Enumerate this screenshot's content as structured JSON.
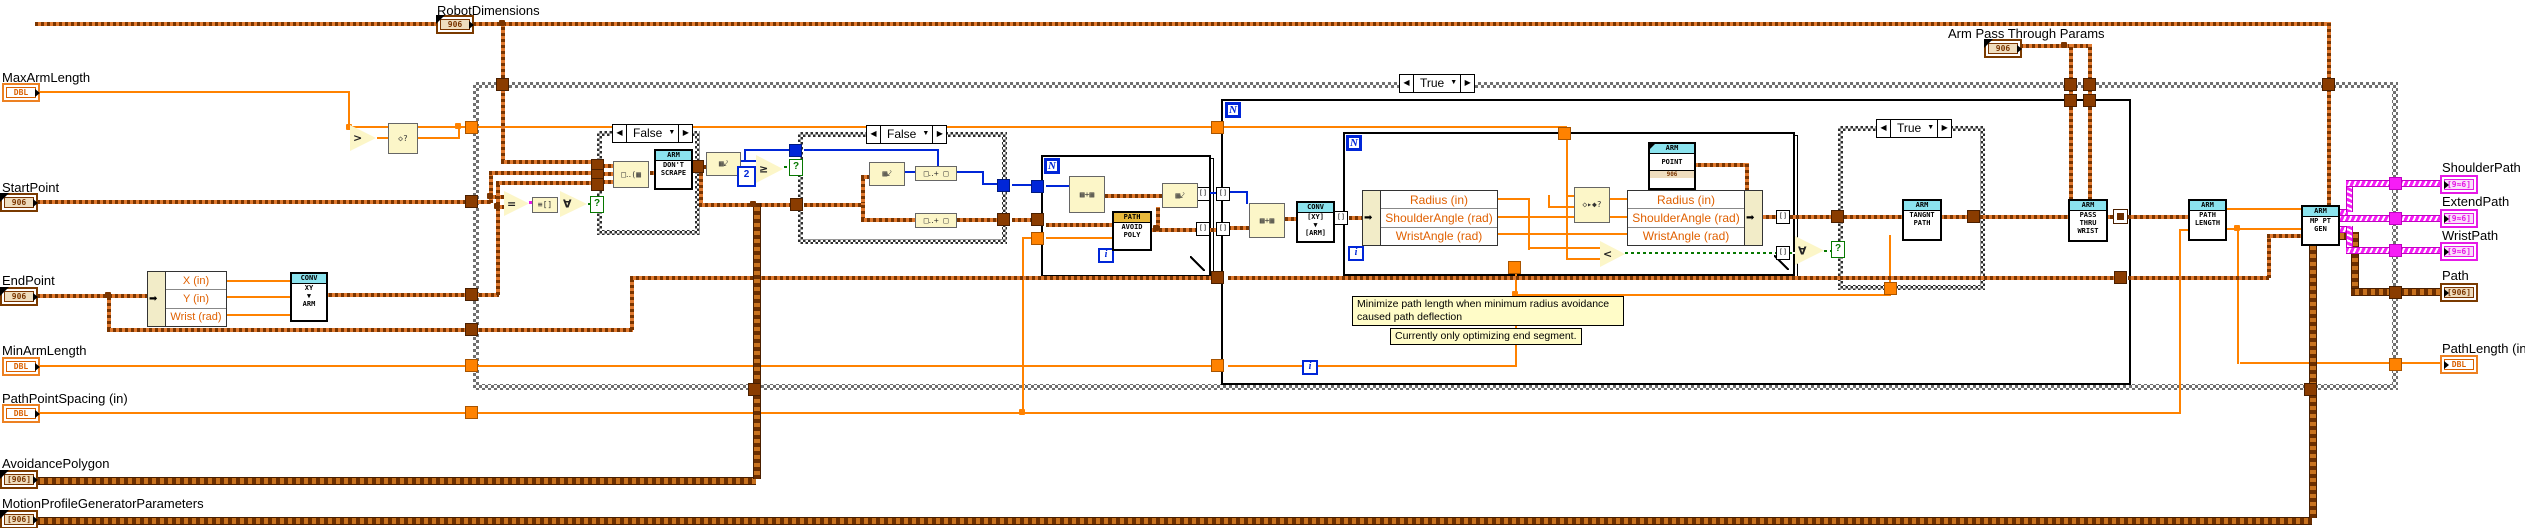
{
  "terminals": {
    "robot_dimensions": {
      "label": "RobotDimensions",
      "glyph": "906"
    },
    "max_arm_length": {
      "label": "MaxArmLength",
      "glyph": "DBL"
    },
    "start_point": {
      "label": "StartPoint",
      "glyph": "906"
    },
    "end_point": {
      "label": "EndPoint",
      "glyph": "906"
    },
    "min_arm_length": {
      "label": "MinArmLength",
      "glyph": "DBL"
    },
    "path_point_spacing": {
      "label": "PathPointSpacing (in)",
      "glyph": "DBL"
    },
    "avoidance_polygon": {
      "label": "AvoidancePolygon",
      "glyph": "[906]"
    },
    "motion_profile_params": {
      "label": "MotionProfileGeneratorParameters",
      "glyph": "[906]"
    },
    "arm_pass_through": {
      "label": "Arm Pass Through Params",
      "glyph": "906"
    },
    "shoulder_path": {
      "label": "ShoulderPath",
      "glyph": "[9≈6]"
    },
    "extend_path": {
      "label": "ExtendPath",
      "glyph": "[9≈6]"
    },
    "wrist_path": {
      "label": "WristPath",
      "glyph": "[9≈6]"
    },
    "path": {
      "label": "Path",
      "glyph": "[906]"
    },
    "path_length": {
      "label": "PathLength (in)",
      "glyph": "DBL"
    }
  },
  "selectors": {
    "outer": "True",
    "case1": "False",
    "case2": "False",
    "case3": "True",
    "prev": "◀",
    "next": "▶",
    "drop": "▼"
  },
  "loops": {
    "n": "N",
    "i": "i"
  },
  "vis": [
    {
      "header": "CONV",
      "lines": [
        "XY",
        "▼",
        "ARM"
      ]
    },
    {
      "header": "ARM",
      "lines": [
        "DON'T",
        "SCRAPE"
      ]
    },
    {
      "header": "PATH",
      "lines": [
        "AVOID",
        "POLY"
      ]
    },
    {
      "header": "CONV",
      "lines": [
        "[XY]",
        "▼",
        "[ARM]"
      ]
    },
    {
      "header": "ARM",
      "lines": [
        "POINT"
      ],
      "foot": "906"
    },
    {
      "header": "ARM",
      "lines": [
        "TANGNT",
        "PATH"
      ]
    },
    {
      "header": "ARM",
      "lines": [
        "PASS",
        "THRU",
        "WRIST"
      ]
    },
    {
      "header": "ARM",
      "lines": [
        "PATH",
        "LENGTH"
      ]
    },
    {
      "header": "ARM",
      "lines": [
        "MP PT",
        "GEN"
      ]
    }
  ],
  "endpoint_unbundle": {
    "rows": [
      "X (in)",
      "Y (in)",
      "Wrist (rad)"
    ]
  },
  "arm_cluster": {
    "rows": [
      "Radius (in)",
      "ShoulderAngle (rad)",
      "WristAngle (rad)"
    ]
  },
  "constants": {
    "two": "2"
  },
  "glyphs": {
    "eq": "=",
    "forall": "∀",
    "lt": "<",
    "ge": "≥",
    "gt": ">",
    "q": "?",
    "build": "▦+▦",
    "size": "▦⤦",
    "index": "□‥+ □",
    "cluster_build": "□‥(▦",
    "select": "◇▸◆?",
    "array_like": "≡[]",
    "diamond_q": "◇?",
    "arrow": "➡"
  },
  "comments": {
    "note1": "Minimize path length when minimum radius avoidance caused path deflection",
    "note2": "Currently only optimizing end segment."
  }
}
